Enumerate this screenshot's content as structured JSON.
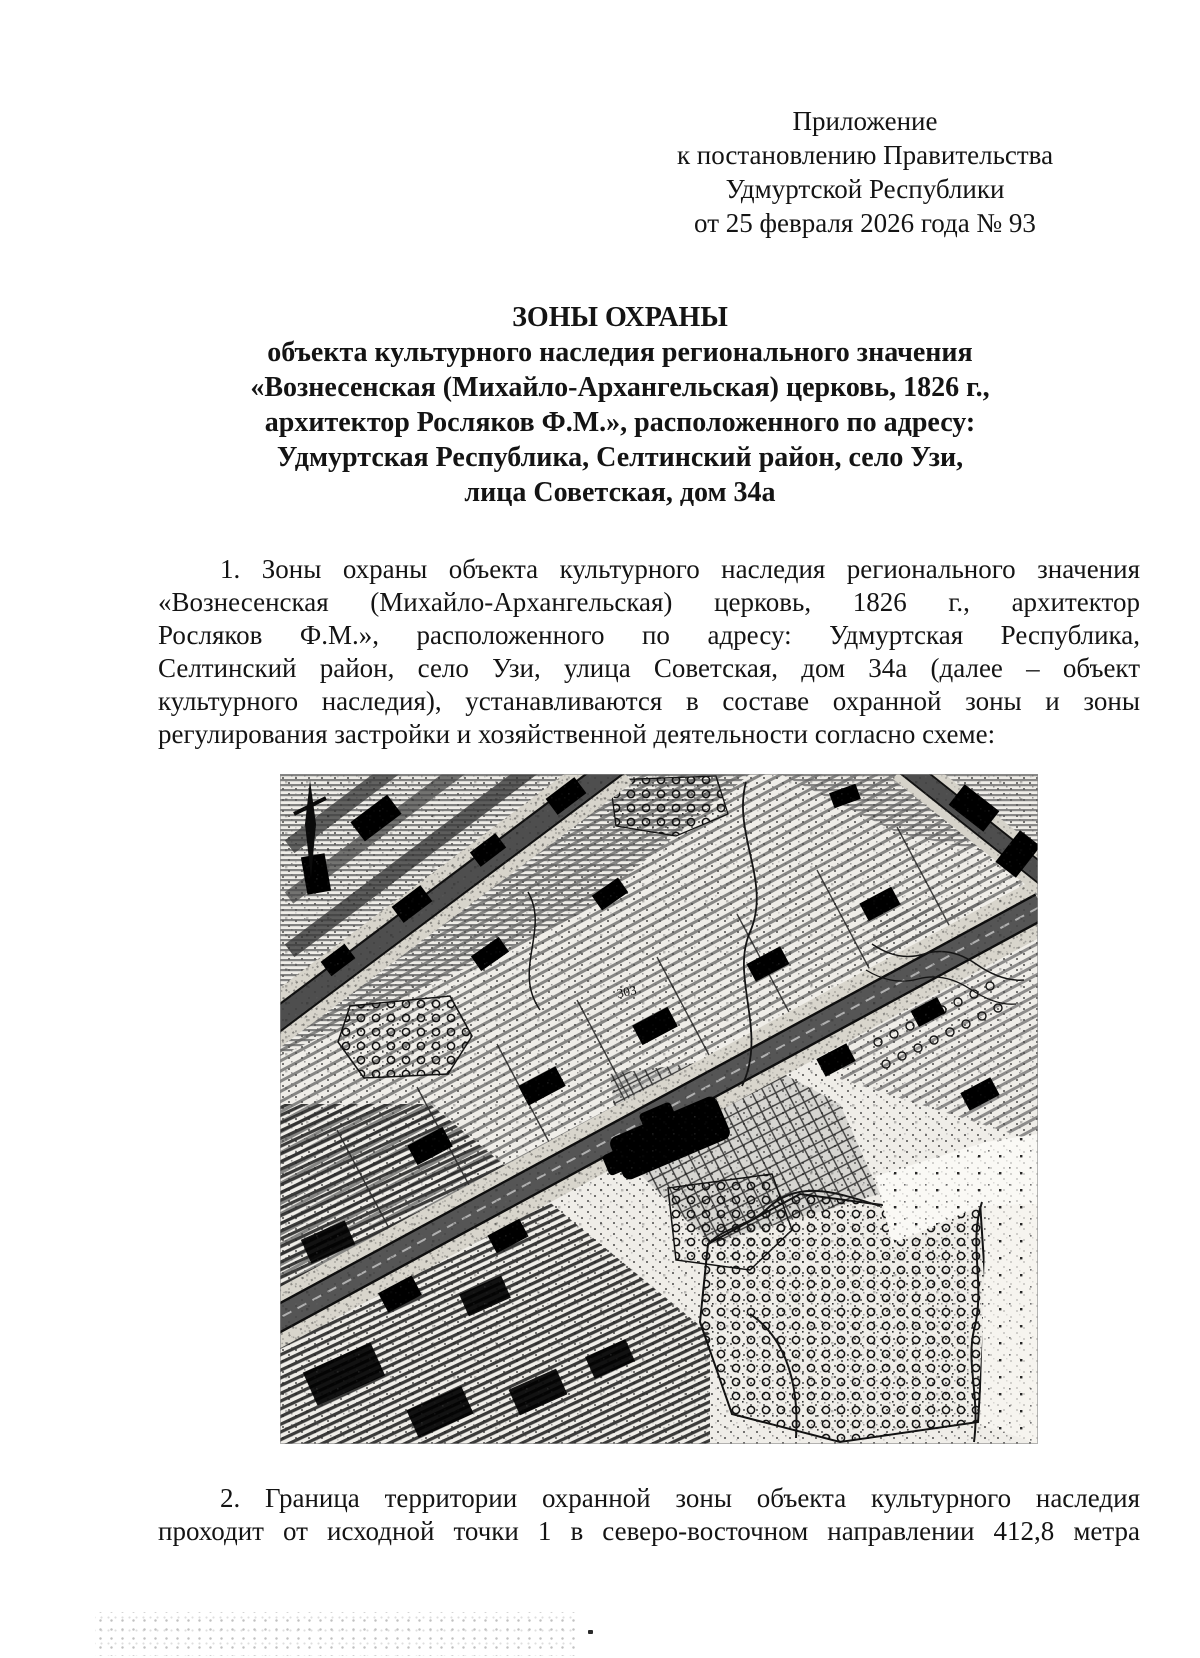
{
  "header": {
    "lines": [
      "Приложение",
      "к постановлению Правительства",
      "Удмуртской Республики",
      "от 25 февраля 2026 года № 93"
    ]
  },
  "title": {
    "lines": [
      "ЗОНЫ ОХРАНЫ",
      "объекта культурного наследия регионального значения",
      "«Вознесенская (Михайло-Архангельская) церковь, 1826 г.,",
      "архитектор Росляков Ф.М.», расположенного по адресу:",
      "Удмуртская Республика, Селтинский район, село Узи,",
      "лица Советская, дом 34а"
    ]
  },
  "paragraph1": {
    "lines": [
      "1. Зоны охраны объекта культурного наследия регионального значения",
      "«Вознесенская (Михайло-Архангельская) церковь, 1826 г., архитектор",
      "Росляков Ф.М.», расположенного по адресу: Удмуртская Республика,",
      "Селтинский район, село Узи, улица Советская, дом 34а (далее – объект",
      "культурного наследия), устанавливаются в составе охранной зоны и зоны",
      "регулирования застройки и хозяйственной деятельности согласно схеме:"
    ]
  },
  "map": {
    "label": "303"
  },
  "paragraph2": {
    "lines": [
      "2. Граница территории охранной зоны объекта культурного наследия",
      "проходит от исходной точки 1 в северо-восточном направлении 412,8 метра"
    ]
  },
  "colors": {
    "ink": "#141414",
    "paper": "#ffffff",
    "road_band": "#555555",
    "verge": "#d8d5cc"
  }
}
